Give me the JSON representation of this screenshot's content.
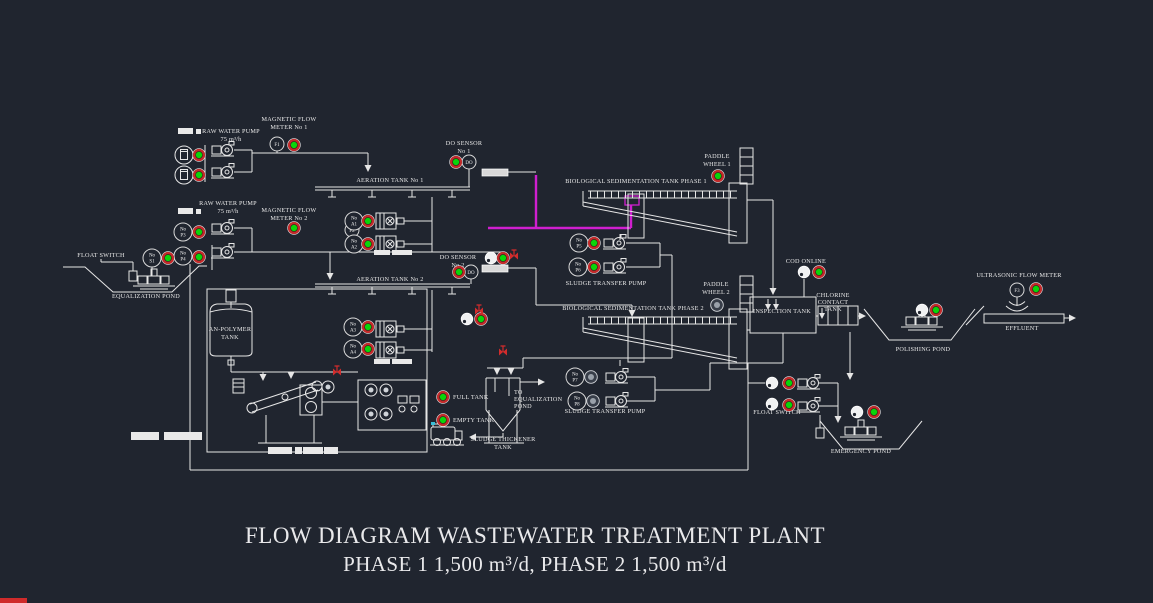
{
  "title": {
    "line1": "FLOW DIAGRAM WASTEWATER TREATMENT PLANT",
    "line2": "PHASE 1 1,500 m³/d, PHASE 2 1,500 m³/d"
  },
  "colors": {
    "background": "#20252f",
    "line": "#e6e6e6",
    "pipe_highlight_magenta": "#cf1fcf",
    "indicator_on_green": "#0ad50a",
    "indicator_ring_red": "#c22a2a",
    "indicator_off_gray": "#9aa1aa",
    "valve_red": "#d22c2c",
    "bottom_strip_red": "#cf2b2b"
  },
  "labels": [
    {
      "name": "label-raw-water-pump-1",
      "x": 231,
      "y": 133,
      "gap": 8,
      "lines": [
        "RAW WATER PUMP",
        "75 m³/h"
      ]
    },
    {
      "name": "label-magnetic-flow-meter-1",
      "x": 289,
      "y": 121,
      "gap": 8,
      "lines": [
        "MAGNETIC FLOW",
        "METER No 1"
      ]
    },
    {
      "name": "label-do-sensor-1",
      "x": 464,
      "y": 145,
      "gap": 8,
      "lines": [
        "DO SENSOR",
        "No 1"
      ]
    },
    {
      "name": "label-aeration-tank-1",
      "x": 390,
      "y": 182,
      "gap": 8,
      "lines": [
        "AERATION TANK  No 1"
      ]
    },
    {
      "name": "label-biological-sedimentation-tank-1",
      "x": 636,
      "y": 183,
      "gap": 8,
      "lines": [
        "BIOLOGICAL SEDIMENTATION TANK PHASE 1"
      ]
    },
    {
      "name": "label-paddle-wheel-1",
      "x": 717,
      "y": 158,
      "gap": 8,
      "lines": [
        "PADDLE",
        "WHEEL 1"
      ]
    },
    {
      "name": "label-raw-water-pump-2",
      "x": 228,
      "y": 205,
      "gap": 8,
      "lines": [
        "RAW WATER PUMP",
        "75 m³/h"
      ]
    },
    {
      "name": "label-magnetic-flow-meter-2",
      "x": 289,
      "y": 212,
      "gap": 8,
      "lines": [
        "MAGNETIC FLOW",
        "METER No 2"
      ]
    },
    {
      "name": "label-float-switch-left",
      "x": 101,
      "y": 257,
      "gap": 8,
      "lines": [
        "FLOAT SWITCH"
      ]
    },
    {
      "name": "label-equalization-pond",
      "x": 146,
      "y": 298,
      "gap": 8,
      "lines": [
        "EQUALIZATION POND"
      ]
    },
    {
      "name": "label-do-sensor-2",
      "x": 458,
      "y": 259,
      "gap": 8,
      "lines": [
        "DO SENSOR",
        "No 2"
      ]
    },
    {
      "name": "label-aeration-tank-2",
      "x": 390,
      "y": 281,
      "gap": 8,
      "lines": [
        "AERATION TANK  No 2"
      ]
    },
    {
      "name": "label-sludge-transfer-pump-1",
      "x": 606,
      "y": 285,
      "gap": 8,
      "lines": [
        "SLUDGE TRANSFER PUMP"
      ]
    },
    {
      "name": "label-biological-sedimentation-tank-2",
      "x": 633,
      "y": 310,
      "gap": 8,
      "lines": [
        "BIOLOGICAL SEDIMENTATION TANK PHASE 2"
      ]
    },
    {
      "name": "label-paddle-wheel-2",
      "x": 716,
      "y": 286,
      "gap": 8,
      "lines": [
        "PADDLE",
        "WHEEL 2"
      ]
    },
    {
      "name": "label-cod-online",
      "x": 806,
      "y": 263,
      "gap": 8,
      "lines": [
        "COD ONLINE"
      ]
    },
    {
      "name": "label-inspection-tank",
      "x": 782,
      "y": 313,
      "gap": 8,
      "lines": [
        "INSPECTION TANK"
      ]
    },
    {
      "name": "label-chlorine-contact-tank",
      "x": 833,
      "y": 297,
      "gap": 7,
      "lines": [
        "CHLORINE",
        "CONTACT",
        "TANK"
      ]
    },
    {
      "name": "label-ultrasonic-flow-meter",
      "x": 1019,
      "y": 277,
      "gap": 8,
      "lines": [
        "ULTRASONIC FLOW METER"
      ]
    },
    {
      "name": "label-effluent",
      "x": 1022,
      "y": 330,
      "gap": 8,
      "lines": [
        "EFFLUENT"
      ]
    },
    {
      "name": "label-polishing-pond",
      "x": 923,
      "y": 351,
      "gap": 8,
      "lines": [
        "POLISHING POND"
      ]
    },
    {
      "name": "label-an-polymer-tank",
      "x": 230,
      "y": 331,
      "gap": 8,
      "lines": [
        "AN-POLYMER",
        "TANK"
      ]
    },
    {
      "name": "label-full-tank",
      "x": 453,
      "y": 399,
      "gap": 8,
      "align": "start",
      "lines": [
        "FULL TANK"
      ]
    },
    {
      "name": "label-empty-tank",
      "x": 453,
      "y": 422,
      "gap": 8,
      "align": "start",
      "lines": [
        "EMPTY TANK"
      ]
    },
    {
      "name": "label-to-equalization-pond",
      "x": 514,
      "y": 394,
      "gap": 7,
      "align": "start",
      "lines": [
        "TO",
        "EQUALIZATION",
        "POND"
      ]
    },
    {
      "name": "label-sludge-thickener-tank",
      "x": 503,
      "y": 441,
      "gap": 8,
      "lines": [
        "SLUDGE THICKENER",
        "TANK"
      ]
    },
    {
      "name": "label-sludge-transfer-pump-2",
      "x": 605,
      "y": 413,
      "gap": 8,
      "lines": [
        "SLUDGE TRANSFER PUMP"
      ]
    },
    {
      "name": "label-float-switch-right",
      "x": 777,
      "y": 414,
      "gap": 8,
      "lines": [
        "FLOAT SWITCH"
      ]
    },
    {
      "name": "label-emergency-pond",
      "x": 861,
      "y": 453,
      "gap": 8,
      "lines": [
        "EMERGENCY POND"
      ]
    }
  ],
  "tags": [
    {
      "name": "tag-flow-meter-f1",
      "x": 277,
      "y": 144,
      "r": 7,
      "lines": [
        "F1"
      ]
    },
    {
      "name": "tag-flow-meter-f2",
      "x": 352,
      "y": 230,
      "r": 7,
      "lines": [
        "F2"
      ]
    },
    {
      "name": "tag-flow-meter-f3",
      "x": 1017,
      "y": 290,
      "r": 7,
      "lines": [
        "F3"
      ]
    },
    {
      "name": "tag-do-1",
      "x": 469,
      "y": 162,
      "r": 7,
      "lines": [
        "DO"
      ]
    },
    {
      "name": "tag-do-2",
      "x": 471,
      "y": 272,
      "r": 7,
      "lines": [
        "DO"
      ]
    },
    {
      "name": "tag-pump-p3",
      "x": 183,
      "y": 232,
      "r": 9,
      "lines": [
        "No",
        "P3"
      ]
    },
    {
      "name": "tag-pump-p4",
      "x": 183,
      "y": 256,
      "r": 9,
      "lines": [
        "No",
        "P4"
      ]
    },
    {
      "name": "tag-switch-s1",
      "x": 152,
      "y": 258,
      "r": 9,
      "lines": [
        "No",
        "S1"
      ]
    },
    {
      "name": "tag-blower-a1",
      "x": 354,
      "y": 221,
      "r": 9,
      "lines": [
        "No",
        "A1"
      ]
    },
    {
      "name": "tag-blower-a2",
      "x": 354,
      "y": 244,
      "r": 9,
      "lines": [
        "No",
        "A2"
      ]
    },
    {
      "name": "tag-blower-a3",
      "x": 353,
      "y": 327,
      "r": 9,
      "lines": [
        "No",
        "A3"
      ]
    },
    {
      "name": "tag-blower-a4",
      "x": 353,
      "y": 349,
      "r": 9,
      "lines": [
        "No",
        "A4"
      ]
    },
    {
      "name": "tag-pump-p5",
      "x": 579,
      "y": 243,
      "r": 9,
      "lines": [
        "No",
        "P5"
      ]
    },
    {
      "name": "tag-pump-p6",
      "x": 578,
      "y": 267,
      "r": 9,
      "lines": [
        "No",
        "P6"
      ]
    },
    {
      "name": "tag-pump-p7",
      "x": 575,
      "y": 377,
      "r": 9,
      "lines": [
        "No",
        "P7"
      ]
    },
    {
      "name": "tag-pump-p8",
      "x": 577,
      "y": 401,
      "r": 9,
      "lines": [
        "No",
        "P8"
      ]
    }
  ],
  "indicators": [
    {
      "name": "indicator-dosing-1",
      "x": 199,
      "y": 155,
      "state": "on"
    },
    {
      "name": "indicator-dosing-2",
      "x": 199,
      "y": 175,
      "state": "on"
    },
    {
      "name": "indicator-flow-meter-1",
      "x": 294,
      "y": 145,
      "state": "on"
    },
    {
      "name": "indicator-flow-meter-2",
      "x": 294,
      "y": 228,
      "state": "on"
    },
    {
      "name": "indicator-pump-p3",
      "x": 199,
      "y": 232,
      "state": "on"
    },
    {
      "name": "indicator-pump-p4",
      "x": 199,
      "y": 257,
      "state": "on"
    },
    {
      "name": "indicator-switch-s1",
      "x": 168,
      "y": 258,
      "state": "on"
    },
    {
      "name": "indicator-blower-a1",
      "x": 368,
      "y": 221,
      "state": "on"
    },
    {
      "name": "indicator-blower-a2",
      "x": 368,
      "y": 244,
      "state": "on"
    },
    {
      "name": "indicator-blower-a3",
      "x": 368,
      "y": 327,
      "state": "on"
    },
    {
      "name": "indicator-blower-a4",
      "x": 368,
      "y": 349,
      "state": "on"
    },
    {
      "name": "indicator-do-1",
      "x": 456,
      "y": 162,
      "state": "on"
    },
    {
      "name": "indicator-do-2",
      "x": 459,
      "y": 272,
      "state": "on"
    },
    {
      "name": "indicator-aeration-out-2",
      "x": 503,
      "y": 258,
      "state": "on"
    },
    {
      "name": "indicator-sed-feed-2",
      "x": 481,
      "y": 319,
      "state": "on"
    },
    {
      "name": "indicator-pump-p5",
      "x": 594,
      "y": 243,
      "state": "on"
    },
    {
      "name": "indicator-pump-p6",
      "x": 594,
      "y": 267,
      "state": "on"
    },
    {
      "name": "indicator-pump-p7",
      "x": 591,
      "y": 377,
      "state": "off"
    },
    {
      "name": "indicator-pump-p8",
      "x": 593,
      "y": 401,
      "state": "off"
    },
    {
      "name": "indicator-paddle-wheel-1",
      "x": 718,
      "y": 176,
      "state": "on"
    },
    {
      "name": "indicator-paddle-wheel-2",
      "x": 717,
      "y": 305,
      "state": "off"
    },
    {
      "name": "indicator-cod-online",
      "x": 819,
      "y": 272,
      "state": "on"
    },
    {
      "name": "indicator-polishing-pond",
      "x": 936,
      "y": 310,
      "state": "on"
    },
    {
      "name": "indicator-ultrasonic-flow-meter",
      "x": 1036,
      "y": 289,
      "state": "on"
    },
    {
      "name": "indicator-float-switch-right-1",
      "x": 789,
      "y": 383,
      "state": "on"
    },
    {
      "name": "indicator-float-switch-right-2",
      "x": 789,
      "y": 405,
      "state": "on"
    },
    {
      "name": "indicator-emergency-pond",
      "x": 874,
      "y": 412,
      "state": "on"
    },
    {
      "name": "indicator-full-tank",
      "x": 443,
      "y": 397,
      "state": "on"
    },
    {
      "name": "indicator-empty-tank",
      "x": 443,
      "y": 420,
      "state": "on"
    }
  ],
  "status_circles": [
    {
      "name": "status-circle-aeration-out-2",
      "x": 491,
      "y": 258
    },
    {
      "name": "status-circle-sed-feed-2",
      "x": 467,
      "y": 319
    },
    {
      "name": "status-circle-cod-online",
      "x": 804,
      "y": 272
    },
    {
      "name": "status-circle-polishing-pond",
      "x": 922,
      "y": 310
    },
    {
      "name": "status-circle-float-switch-right-1",
      "x": 772,
      "y": 383
    },
    {
      "name": "status-circle-float-switch-right-2",
      "x": 772,
      "y": 404
    },
    {
      "name": "status-circle-emergency-pond",
      "x": 857,
      "y": 412
    }
  ],
  "valves": [
    {
      "name": "valve-1",
      "x": 514,
      "y": 256
    },
    {
      "name": "valve-2",
      "x": 479,
      "y": 311
    },
    {
      "name": "valve-3",
      "x": 503,
      "y": 352
    },
    {
      "name": "valve-4",
      "x": 337,
      "y": 372
    }
  ],
  "white_blocks": [
    {
      "x": 178,
      "y": 128,
      "w": 15,
      "h": 6
    },
    {
      "x": 196,
      "y": 129,
      "w": 5,
      "h": 5
    },
    {
      "x": 178,
      "y": 208,
      "w": 15,
      "h": 6
    },
    {
      "x": 196,
      "y": 209,
      "w": 5,
      "h": 5
    },
    {
      "x": 374,
      "y": 250,
      "w": 16,
      "h": 5
    },
    {
      "x": 392,
      "y": 250,
      "w": 20,
      "h": 5
    },
    {
      "x": 374,
      "y": 359,
      "w": 16,
      "h": 5
    },
    {
      "x": 392,
      "y": 359,
      "w": 20,
      "h": 5
    },
    {
      "x": 131,
      "y": 432,
      "w": 28,
      "h": 8
    },
    {
      "x": 164,
      "y": 432,
      "w": 38,
      "h": 8
    },
    {
      "x": 268,
      "y": 447,
      "w": 24,
      "h": 7
    },
    {
      "x": 295,
      "y": 447,
      "w": 7,
      "h": 7
    },
    {
      "x": 303,
      "y": 447,
      "w": 20,
      "h": 7
    },
    {
      "x": 324,
      "y": 447,
      "w": 14,
      "h": 7
    }
  ]
}
